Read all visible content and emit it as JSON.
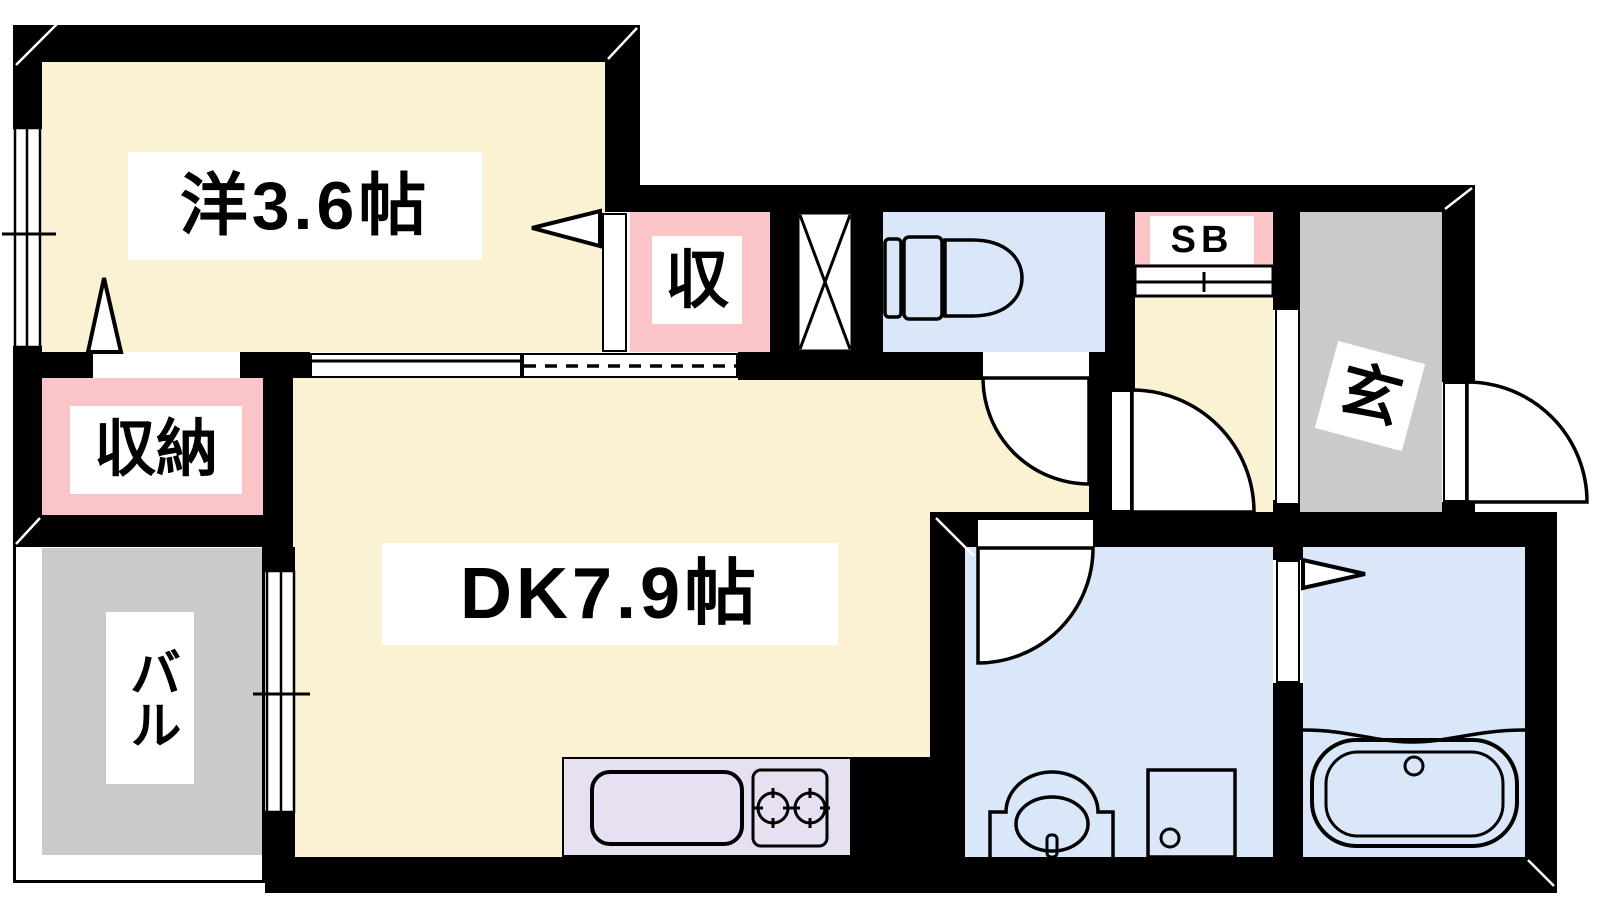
{
  "floorplan": {
    "type": "apartment-floor-plan",
    "rooms": {
      "western_room": {
        "label": "洋3.6帖",
        "size_jo": "3.6",
        "floor_color": "#FBF1D3"
      },
      "dining_kitchen": {
        "label": "DK7.9帖",
        "size_jo": "7.9",
        "floor_color": "#FBF1D3"
      },
      "closet": {
        "label": "収",
        "floor_color": "#FBC5C7"
      },
      "storage": {
        "label": "収納",
        "floor_color": "#FBC5C7"
      },
      "shoe_box": {
        "label": "SB",
        "floor_color": "#FBC5C7"
      },
      "balcony": {
        "label": "バル",
        "floor_color": "#CACACA"
      },
      "entrance": {
        "label": "玄",
        "floor_color": "#CACACA"
      },
      "toilet": {
        "label": "",
        "floor_color": "#D9E7F9"
      },
      "washroom": {
        "label": "",
        "floor_color": "#D9E7F9"
      },
      "bathroom": {
        "label": "",
        "floor_color": "#D9E7F9"
      },
      "kitchen_counter": {
        "label": "",
        "floor_color": "#E7E0F3"
      }
    },
    "icons": {
      "pipe_space": "x-cross-box",
      "toilet_fixture": "toilet-icon",
      "washbasin_fixture": "washbasin-icon",
      "washing_machine_fixture": "washing-machine-icon",
      "bathtub_fixture": "bathtub-icon",
      "kitchen_sink_fixture": "sink-icon",
      "stove_fixture": "two-burner-stove-icon"
    },
    "colors": {
      "wall": "#000000",
      "room_cream": "#FBF1D3",
      "storage_pink": "#FBC5C7",
      "water_blue": "#D9E7F9",
      "gray": "#CACACA",
      "kitchen_lavender": "#E7E0F3",
      "background": "#FFFFFF"
    }
  }
}
